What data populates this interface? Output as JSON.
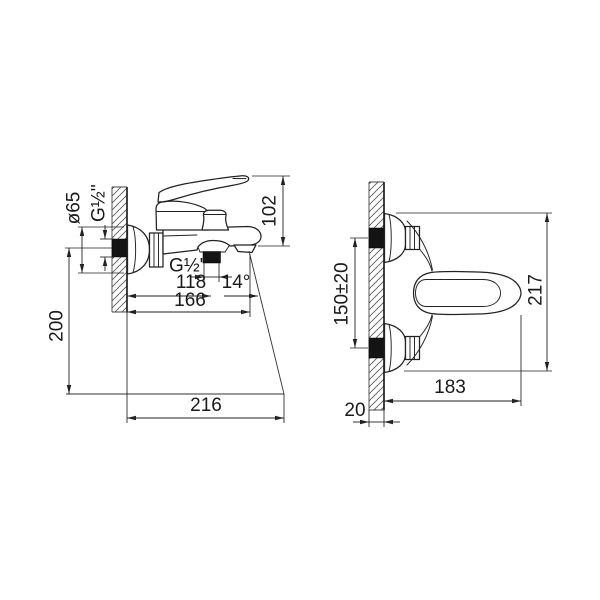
{
  "drawing": {
    "left_view": {
      "escutcheon_diameter": "ø65",
      "wall_connection_thread": "G½''",
      "height_above_axis": "102",
      "shower_outlet_thread": "G½''",
      "wall_to_outlet": "118",
      "spout_angle": "14°",
      "wall_to_spout_tip": "166",
      "axis_to_stream_plane": "200",
      "stream_reach": "216"
    },
    "right_view": {
      "inlet_spacing": "150±20",
      "overall_height": "217",
      "projection": "183",
      "wall_thickness": "20"
    }
  }
}
